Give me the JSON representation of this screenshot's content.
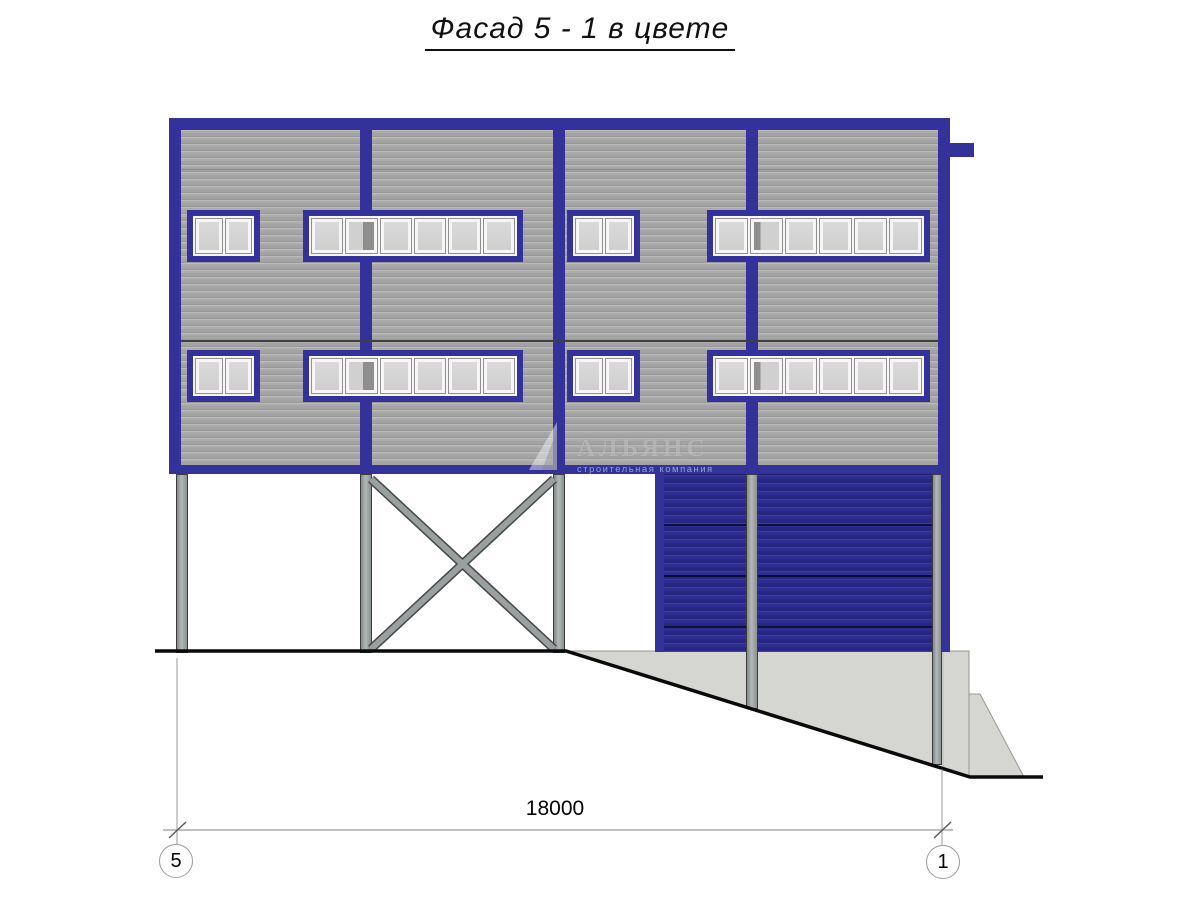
{
  "title": "Фасад 5 - 1 в цвете",
  "watermark": {
    "name": "АЛЬЯНС",
    "subtitle": "строительная компания"
  },
  "dimension_label": "18000",
  "axis_left": "5",
  "axis_right": "1",
  "colors": {
    "frame_blue": "#32329a",
    "gate_blue": "#2d2d92",
    "siding_gray": "#a9a9a9",
    "glass_gray": "#d3d3d3",
    "column_gray": "#9aa0a0",
    "concrete_gray": "#d5d5d2"
  },
  "facade": {
    "windows": [
      {
        "x": 187,
        "y": 210,
        "w": 73,
        "h": 52,
        "panes": 2
      },
      {
        "x": 303,
        "y": 210,
        "w": 220,
        "h": 52,
        "panes": 6,
        "dark_pane": 2,
        "dark_side": "right"
      },
      {
        "x": 567,
        "y": 210,
        "w": 73,
        "h": 52,
        "panes": 2
      },
      {
        "x": 707,
        "y": 210,
        "w": 223,
        "h": 52,
        "panes": 6,
        "dark_pane": 2,
        "dark_side": "left"
      },
      {
        "x": 187,
        "y": 350,
        "w": 73,
        "h": 52,
        "panes": 2
      },
      {
        "x": 303,
        "y": 350,
        "w": 220,
        "h": 52,
        "panes": 6,
        "dark_pane": 2,
        "dark_side": "right"
      },
      {
        "x": 567,
        "y": 350,
        "w": 73,
        "h": 52,
        "panes": 2
      },
      {
        "x": 707,
        "y": 350,
        "w": 223,
        "h": 52,
        "panes": 6,
        "dark_pane": 2,
        "dark_side": "left"
      }
    ]
  }
}
